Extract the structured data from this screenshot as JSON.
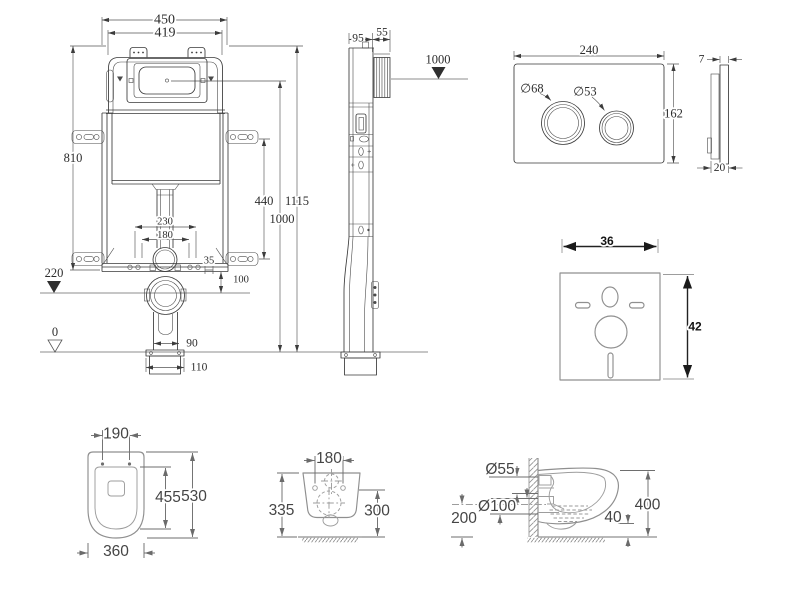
{
  "drawing_labels": {
    "frame_front": {
      "width_outer": "450",
      "width_inner": "419",
      "height": "810",
      "bracket_span": "440",
      "total_height": "1115",
      "level_top": "1000",
      "bolt_span_outer": "230",
      "bolt_span_inner": "180",
      "offset_small": "35",
      "outlet_offset": "100",
      "level_outlet": "220",
      "level_floor": "0",
      "pipe_width": "90",
      "flange_width": "110"
    },
    "frame_side": {
      "depth_frame": "95",
      "depth_housing": "55",
      "level_top": "1000"
    },
    "flush_plate": {
      "width": "240",
      "height": "162",
      "big_button": "∅68",
      "small_button": "∅53"
    },
    "flush_plate_side": {
      "thickness_plate": "7",
      "thickness_total": "20"
    },
    "sound_mat": {
      "width": "36",
      "height": "42"
    },
    "bowl_top": {
      "hole_span": "190",
      "inner_length": "455",
      "length": "530",
      "width": "360"
    },
    "bowl_rear": {
      "hole_span": "180",
      "height_outer": "335",
      "height_holes": "300"
    },
    "bowl_side": {
      "inlet": "Ø55",
      "outlet": "Ø100",
      "outlet_height": "200",
      "depth": "400",
      "bottom_gap": "40"
    }
  }
}
